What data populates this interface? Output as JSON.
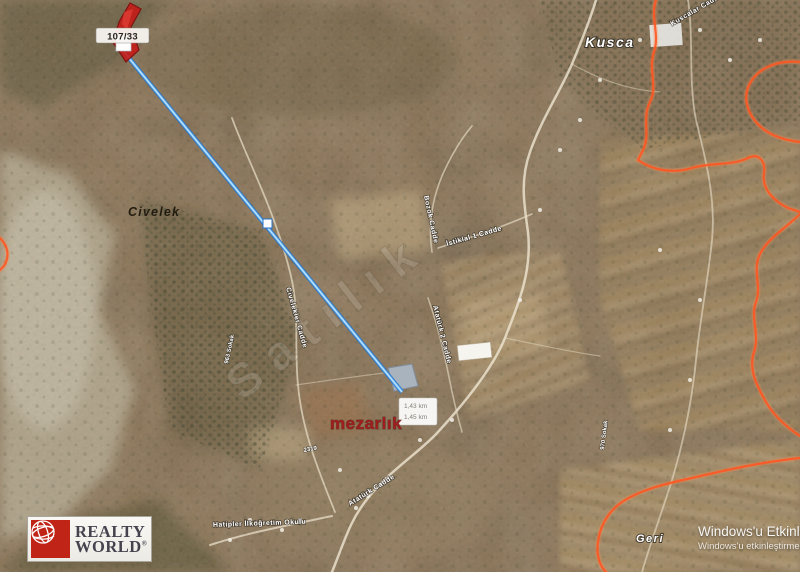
{
  "map": {
    "parcel_label": "107/33",
    "measure_box": {
      "line1": "1,43 km",
      "line2": "1,45 km"
    },
    "place_labels": {
      "kusca": "Kusca",
      "civelek": "Civelek",
      "geri": "Geri",
      "mezarlik": "mezarlık",
      "school": "Hatipler İlköğretim Okulu"
    },
    "road_labels": [
      {
        "text": "Bozok Cadde"
      },
      {
        "text": "İstiklal 1 Cadde"
      },
      {
        "text": "Civelekler Cadde"
      },
      {
        "text": "Atatürk 2 Cadde"
      },
      {
        "text": "Atatürk Cadde"
      },
      {
        "text": "Kuscalar Cadde"
      },
      {
        "text": "963 Sokak"
      },
      {
        "text": "970 Sokak"
      },
      {
        "text": "2319"
      }
    ],
    "watermark": "Satılık",
    "colors": {
      "measure_line_core": "#b8e4ff",
      "measure_line_edge": "#2470c8",
      "parcel_red": "#c41e1a",
      "boundary_orange": "#ff5722",
      "cemetery_text": "#9e1d1d"
    }
  },
  "logo": {
    "line1": "REALTY",
    "line2": "WORLD",
    "reg": "®"
  },
  "windows_activation": {
    "line1": "Windows'u Etkinleştir",
    "line2": "Windows'u etkinleştirmek için"
  }
}
